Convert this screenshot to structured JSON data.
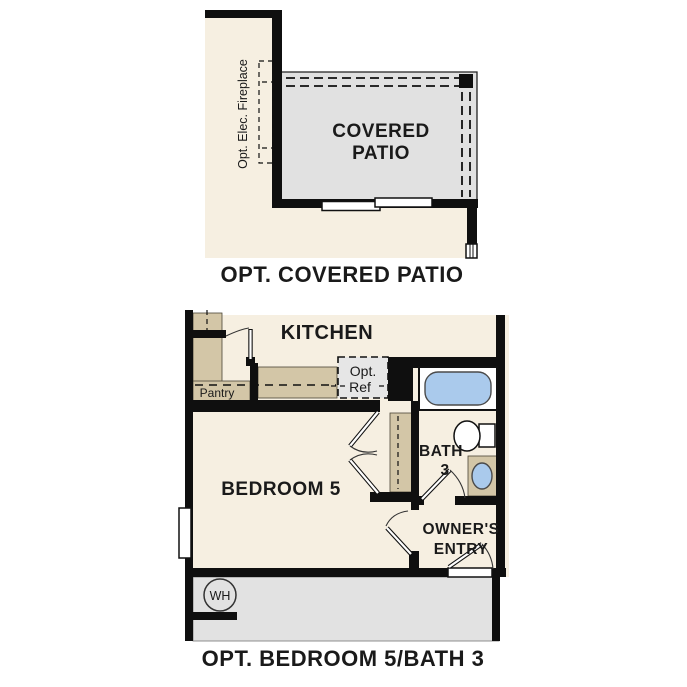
{
  "colors": {
    "wall": "#0f0f0f",
    "cream": "#f6efe1",
    "tan": "#d3c6a7",
    "patio_gray": "#e1e1e1",
    "garage_gray": "#e2e2e2",
    "ref_gray": "#e6e6e6",
    "fixture_blue": "#aacaec"
  },
  "top_plan": {
    "caption": "OPT. COVERED PATIO",
    "labels": {
      "fireplace": "Opt. Elec. Fireplace",
      "patio_line1": "COVERED",
      "patio_line2": "PATIO"
    }
  },
  "bottom_plan": {
    "caption": "OPT. BEDROOM 5/BATH 3",
    "labels": {
      "kitchen": "KITCHEN",
      "pantry": "Pantry",
      "ref_line1": "Opt.",
      "ref_line2": "Ref",
      "bedroom": "BEDROOM 5",
      "bath_line1": "BATH",
      "bath_line2": "3",
      "entry_line1": "OWNER'S",
      "entry_line2": "ENTRY",
      "water_heater": "WH"
    }
  }
}
